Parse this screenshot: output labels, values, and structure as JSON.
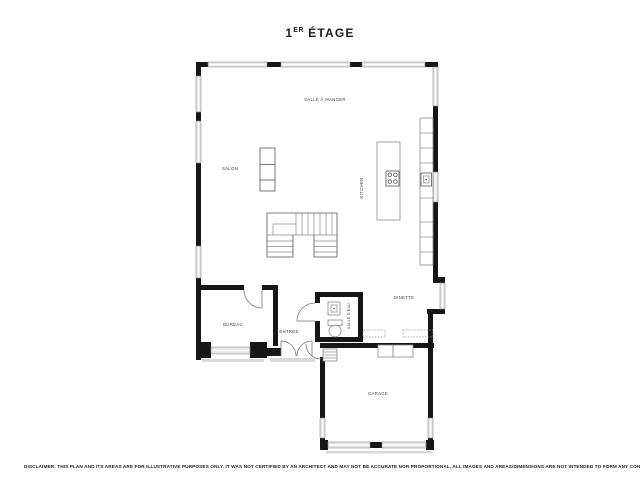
{
  "header": {
    "title_num": "1",
    "title_sup": "ER",
    "title_rest": "ÉTAGE"
  },
  "rooms": {
    "salle_a_manger": "SALLE À MANGER",
    "salon": "SALON",
    "kitchen": "KITCHEN",
    "dinette": "DINETTE",
    "bureau": "BUREAU",
    "entree": "ENTRÉE",
    "salle_deau": "SALLE D'EAU",
    "garage": "GARAGE"
  },
  "disclaimer": "DISCLAIMER: THIS PLAN AND ITS AREAS ARE FOR ILLUSTRATIVE PURPOSES ONLY. IT WAS NOT CERTIFIED BY AN ARCHITECT AND MAY NOT BE ACCURATE NOR PROPORTIONAL. ALL IMAGES AND AREAS/DIMENSIONS ARE NOT INTENDED TO FORM ANY CONTRACT OR WARRANTY.",
  "colors": {
    "wall": "#161616",
    "window_fill": "#e4e4e4",
    "window_stroke": "#8f8f8f",
    "furniture_line": "#8a8a8a",
    "label_text": "#3c3c3c",
    "background": "#ffffff"
  }
}
